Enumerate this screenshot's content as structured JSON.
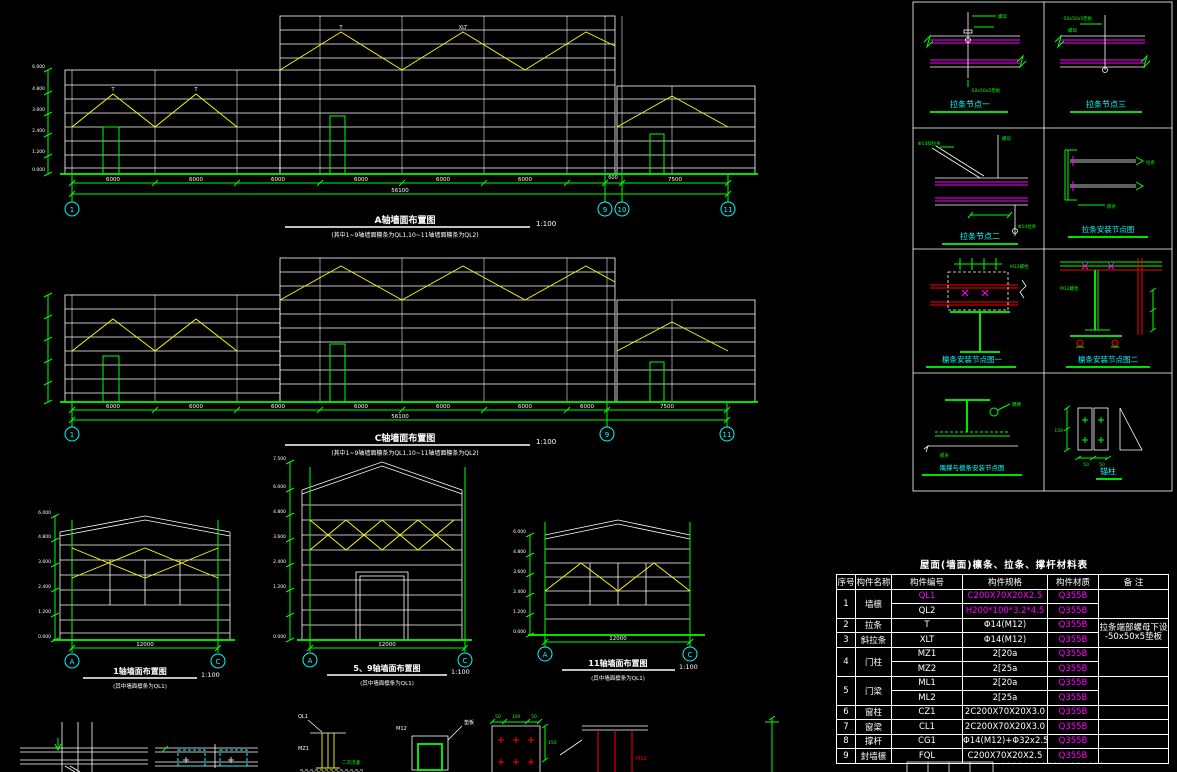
{
  "elev_a": {
    "title": "A轴墙面布置图",
    "scale": "1:100",
    "note": "(其中1~9轴墙面檩条为QL1,10~11轴墙面檩条为QL2)",
    "bubbles": [
      "1",
      "9",
      "10",
      "11"
    ],
    "dims": [
      "6000",
      "6000",
      "6000",
      "6000",
      "6000",
      "6000",
      "600",
      "7500"
    ],
    "total_dim": "56100",
    "levels": [
      "6.000",
      "4.800",
      "3.600",
      "2.400",
      "1.200",
      "0.000"
    ],
    "member": {
      "tie": "T",
      "diag": "XLT"
    }
  },
  "elev_c": {
    "title": "C轴墙面布置图",
    "scale": "1:100",
    "note": "(其中1~9轴墙面檩条为QL1,10~11轴墙面檩条为QL2)",
    "bubbles": [
      "1",
      "9",
      "11"
    ],
    "dims": [
      "6000",
      "6000",
      "6000",
      "6000",
      "6000",
      "6000",
      "6000",
      "7500"
    ],
    "total_dim": "56100"
  },
  "elev_1": {
    "title": "1轴墙面布置图",
    "scale": "1:100",
    "note": "(其中墙面檩条为QL1)",
    "bubbles": [
      "A",
      "C"
    ],
    "dim": "12000",
    "levels": [
      "6.000",
      "4.800",
      "3.600",
      "2.400",
      "1.200",
      "0.000"
    ]
  },
  "elev_59": {
    "title": "5、9轴墙面布置图",
    "scale": "1:100",
    "note": "(其中墙面檩条为QL1)",
    "bubbles": [
      "A",
      "C"
    ],
    "dim": "12000",
    "levels": [
      "7.500",
      "6.000",
      "4.800",
      "3.600",
      "2.400",
      "1.200",
      "0.000"
    ]
  },
  "elev_11": {
    "title": "11轴墙面布置图",
    "scale": "1:100",
    "note": "(其中墙面檩条为QL1)",
    "bubbles": [
      "A",
      "C"
    ],
    "dim": "12000",
    "levels": [
      "6.000",
      "4.800",
      "3.600",
      "2.400",
      "1.200",
      "0.000"
    ]
  },
  "details": {
    "d1": {
      "title": "拉条节点一",
      "labels": [
        "螺母",
        "-50x50x5垫板"
      ]
    },
    "d2": {
      "title": "拉条节点三",
      "labels": [
        "-50x50x5垫板",
        "螺母"
      ]
    },
    "d3": {
      "title": "拉条节点二",
      "labels": [
        "Φ14斜拉条",
        "螺母",
        "Φ14拉条"
      ]
    },
    "d4": {
      "title": "拉条安装节点图",
      "labels": [
        "拉条",
        "檩条"
      ]
    },
    "d5": {
      "title": "檩条安装节点图一",
      "labels": [
        "M12螺栓"
      ]
    },
    "d6": {
      "title": "檩条安装节点图二",
      "labels": [
        "M12螺栓"
      ]
    },
    "d7": {
      "title": "隅撑与檩条安装节点图",
      "labels": [
        "隅撑",
        "檩条"
      ]
    },
    "d8": {
      "title": "锚柱",
      "dims": [
        "50",
        "50",
        "150"
      ]
    }
  },
  "table": {
    "title": "屋面(墙面)檩条、拉条、撑杆材料表",
    "headers": [
      "序号",
      "构件名称",
      "构件编号",
      "构件规格",
      "构件材质",
      "备  注"
    ],
    "rows": [
      {
        "no": "1",
        "name": "墙檩",
        "id": "QL1",
        "spec": "C200X70X20X2.5",
        "mat": "Q355B"
      },
      {
        "id": "QL2",
        "spec": "H200*100*3.2*4.5",
        "mat": "Q355B"
      },
      {
        "no": "2",
        "name": "拉条",
        "id": "T",
        "spec": "Φ14(M12)",
        "mat": "Q355B",
        "remark": "拉条端部螺母下设\n-50x50x5垫板"
      },
      {
        "no": "3",
        "name": "斜拉条",
        "id": "XLT",
        "spec": "Φ14(M12)",
        "mat": "Q355B"
      },
      {
        "no": "4",
        "name": "门柱",
        "id": "MZ1",
        "spec": "2[20a",
        "mat": "Q355B"
      },
      {
        "id": "MZ2",
        "spec": "2[25a",
        "mat": "Q355B"
      },
      {
        "no": "5",
        "name": "门梁",
        "id": "ML1",
        "spec": "2[20a",
        "mat": "Q355B"
      },
      {
        "id": "ML2",
        "spec": "2[25a",
        "mat": "Q355B"
      },
      {
        "no": "6",
        "name": "窗柱",
        "id": "CZ1",
        "spec": "2C200X70X20X3.0",
        "mat": "Q355B"
      },
      {
        "no": "7",
        "name": "窗梁",
        "id": "CL1",
        "spec": "2C200X70X20X3.0",
        "mat": "Q355B"
      },
      {
        "no": "8",
        "name": "撑杆",
        "id": "CG1",
        "spec": "Φ14(M12)+Φ32x2.5",
        "mat": "Q355B"
      },
      {
        "no": "9",
        "name": "封墙檩",
        "id": "FQL",
        "spec": "C200X70X20X2.5",
        "mat": "Q355B"
      }
    ]
  },
  "bottom_strip": {
    "col_label": "MZ1",
    "purlin_label": "QL1",
    "grout_label": "二次浇灌",
    "bolt_label": "M12",
    "pad_label": "垫板",
    "dim50": "50",
    "dim100": "100",
    "dim150": "150"
  },
  "footer_note": "· · · · · · · · · · · · · · · · · ·"
}
